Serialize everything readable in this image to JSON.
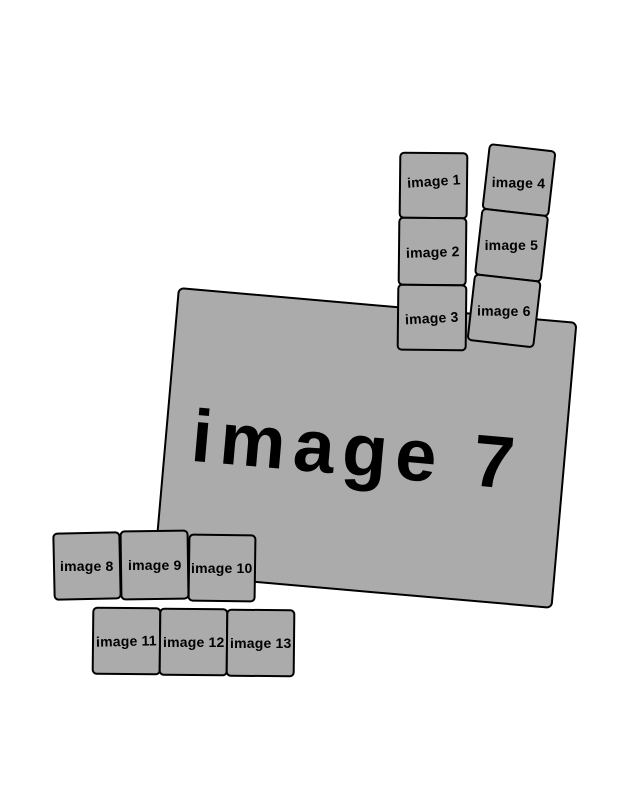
{
  "colors": {
    "background": "#ffffff",
    "card_fill": "#ababab",
    "card_border": "#000000",
    "label_color": "#000000"
  },
  "cards": [
    {
      "label": "image 1"
    },
    {
      "label": "image 2"
    },
    {
      "label": "image 3"
    },
    {
      "label": "image 4"
    },
    {
      "label": "image 5"
    },
    {
      "label": "image 6"
    },
    {
      "label": "image 7"
    },
    {
      "label": "image 8"
    },
    {
      "label": "image 9"
    },
    {
      "label": "image 10"
    },
    {
      "label": "image 11"
    },
    {
      "label": "image 12"
    },
    {
      "label": "image 13"
    }
  ]
}
